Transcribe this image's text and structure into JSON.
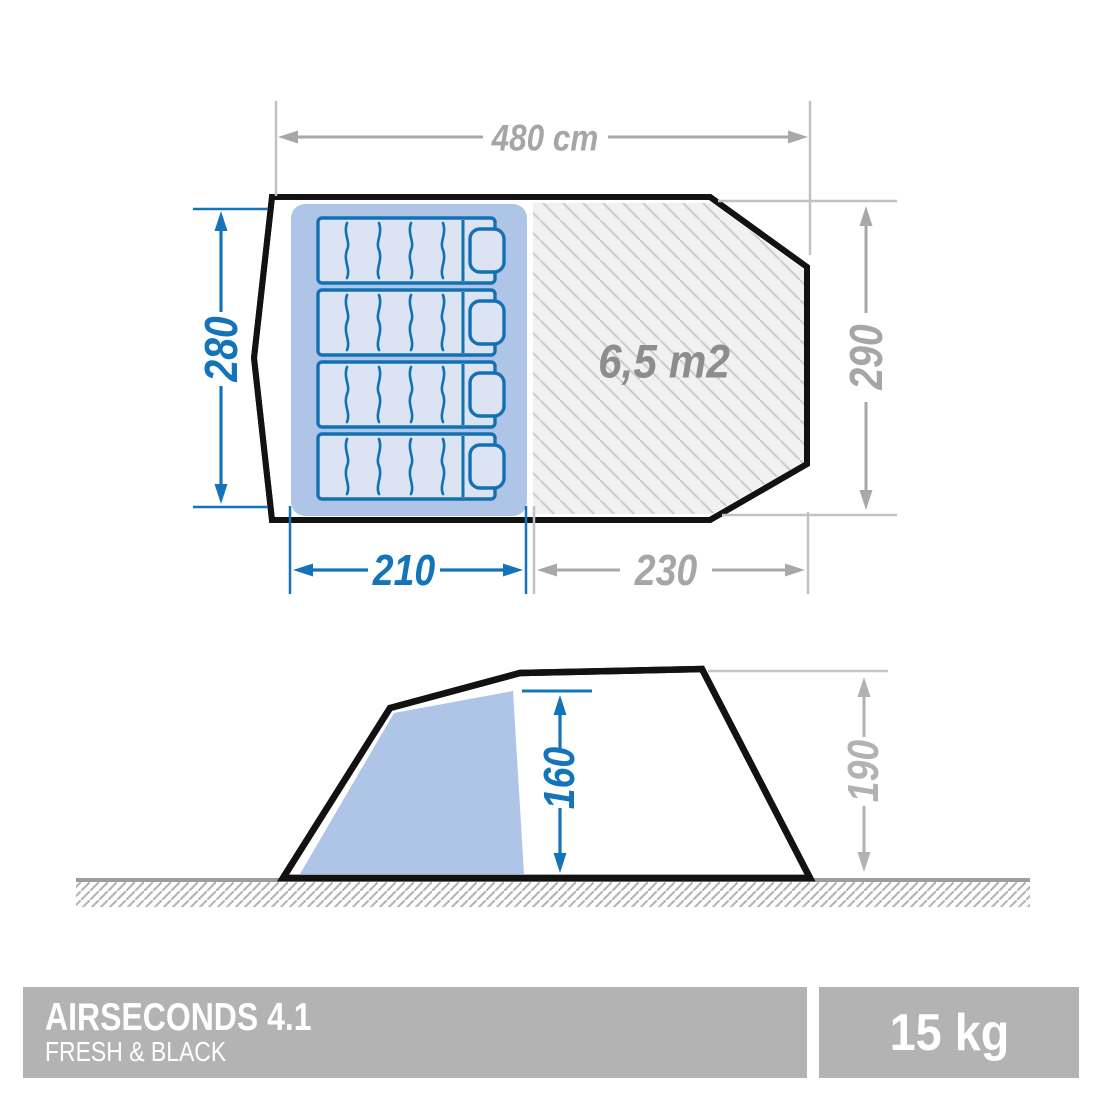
{
  "top_view": {
    "width_total_label": "480 cm",
    "sleeping_depth_label": "280",
    "total_depth_label": "290",
    "sleeping_length_label": "210",
    "living_length_label": "230",
    "living_area_label": "6,5 m2",
    "bed_count": 4
  },
  "side_view": {
    "interior_height_label": "160",
    "total_height_label": "190"
  },
  "footer": {
    "product_name": "AIRSECONDS 4.1",
    "product_line": "FRESH & BLACK",
    "weight": "15 kg"
  },
  "colors": {
    "dimension_blue": "#1474ba",
    "dimension_gray": "#a6a6a6",
    "area_text_gray": "#8d8d8d",
    "cabin_blue": "#aec5e7",
    "mattress_fill": "#dce4f4",
    "mattress_stroke": "#1470b4",
    "tent_outline": "#121212",
    "living_hatch_bg": "#f1f1f1",
    "living_hatch_line": "#cbcbcb",
    "ground_line": "#9d9d9d",
    "ground_hatch_line": "#b5b5b5",
    "footer_bar_gray": "#b3b3b3"
  }
}
